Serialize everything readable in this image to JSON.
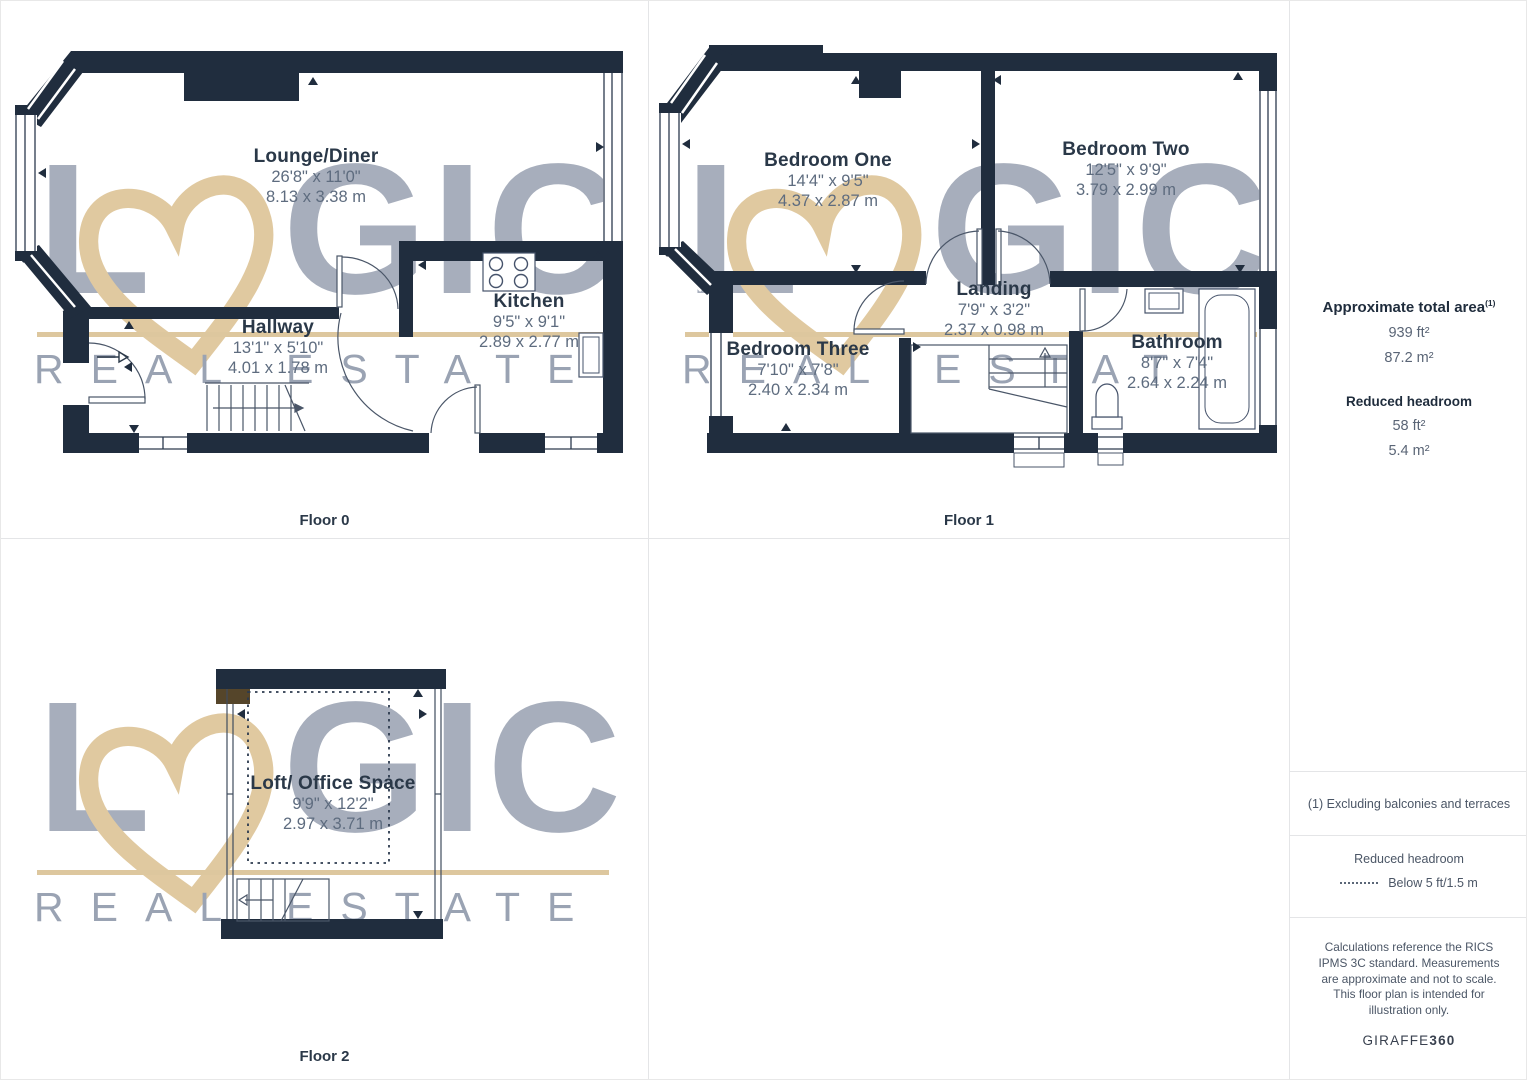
{
  "floors": [
    {
      "caption": "Floor 0",
      "rooms": [
        {
          "name": "Lounge/Diner",
          "imperial": "26'8\" x 11'0\"",
          "metric": "8.13 x 3.38 m"
        },
        {
          "name": "Hallway",
          "imperial": "13'1\" x 5'10\"",
          "metric": "4.01 x 1.78 m"
        },
        {
          "name": "Kitchen",
          "imperial": "9'5\" x 9'1\"",
          "metric": "2.89 x 2.77 m"
        }
      ]
    },
    {
      "caption": "Floor 1",
      "rooms": [
        {
          "name": "Bedroom One",
          "imperial": "14'4\" x 9'5\"",
          "metric": "4.37 x 2.87 m"
        },
        {
          "name": "Bedroom Two",
          "imperial": "12'5\" x 9'9\"",
          "metric": "3.79 x 2.99 m"
        },
        {
          "name": "Landing",
          "imperial": "7'9\" x 3'2\"",
          "metric": "2.37 x 0.98 m"
        },
        {
          "name": "Bedroom Three",
          "imperial": "7'10\" x 7'8\"",
          "metric": "2.40 x 2.34 m"
        },
        {
          "name": "Bathroom",
          "imperial": "8'7\" x 7'4\"",
          "metric": "2.64 x 2.24 m"
        }
      ]
    },
    {
      "caption": "Floor 2",
      "rooms": [
        {
          "name": "Loft/ Office Space",
          "imperial": "9'9\" x 12'2\"",
          "metric": "2.97 x 3.71 m"
        }
      ]
    }
  ],
  "watermark": {
    "letter_l": "L",
    "letters_gic": "GIC",
    "heart_icon": "brush-heart",
    "subtitle": "REAL ESTATE"
  },
  "sidebar": {
    "total_area_label": "Approximate total area",
    "footnote_marker": "(1)",
    "total_ft": "939 ft²",
    "total_m": "87.2 m²",
    "reduced_label": "Reduced headroom",
    "reduced_ft": "58 ft²",
    "reduced_m": "5.4 m²",
    "footnote": "(1) Excluding balconies and terraces",
    "legend_title": "Reduced headroom",
    "legend_text": "Below 5 ft/1.5 m",
    "disclaimer": "Calculations reference the RICS IPMS 3C standard. Measurements are approximate and not to scale. This floor plan is intended for illustration only.",
    "brand_name": "GIRAFFE",
    "brand_number": "360"
  },
  "colors": {
    "wall": "#202d3e",
    "accent_tan": "#ddc79e",
    "watermark_gray": "#a7aebc",
    "label_navy": "#2a3848",
    "dim_gray": "#5e6c7f"
  }
}
